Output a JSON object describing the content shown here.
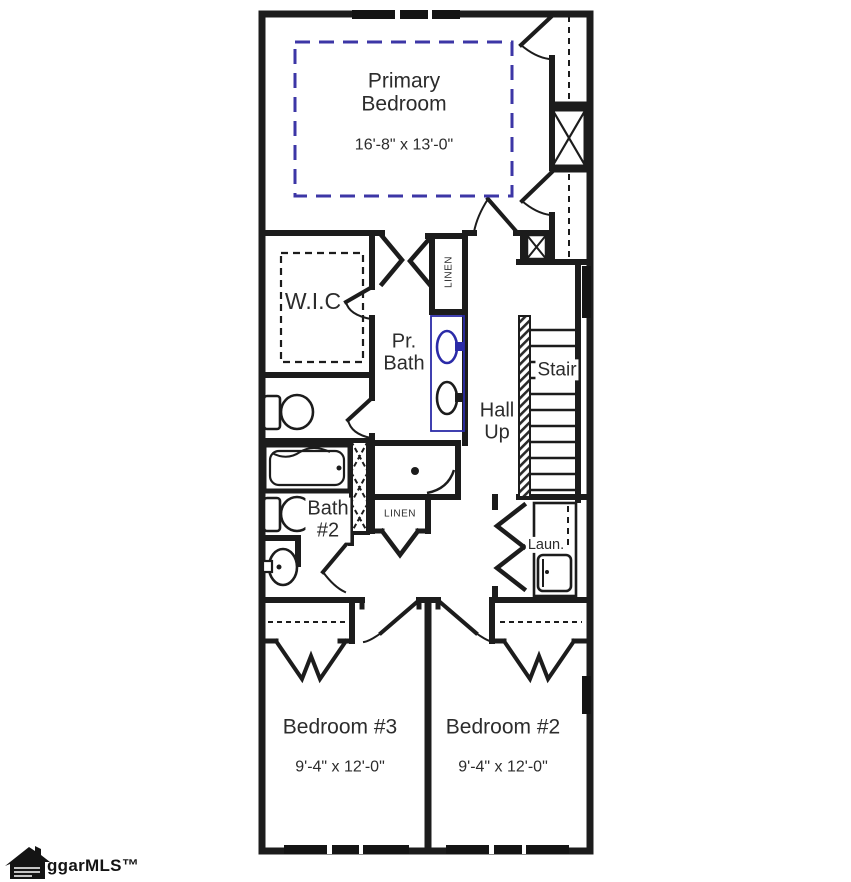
{
  "plan": {
    "rooms": {
      "primary_bedroom": {
        "name": "Primary\nBedroom",
        "dimensions": "16'-8\" x 13'-0\""
      },
      "wic": {
        "name": "W.I.C"
      },
      "primary_bath": {
        "name": "Pr.\nBath"
      },
      "hall": {
        "name": "Hall\nUp"
      },
      "stair": {
        "name": "Stair"
      },
      "bath_2": {
        "name": "Bath\n#2"
      },
      "laundry": {
        "name": "Laun."
      },
      "linen_upper": {
        "name": "LINEN"
      },
      "linen_lower": {
        "name": "LINEN"
      },
      "bedroom_3": {
        "name": "Bedroom #3",
        "dimensions": "9'-4\" x 12'-0\""
      },
      "bedroom_2": {
        "name": "Bedroom #2",
        "dimensions": "9'-4\" x 12'-0\""
      }
    },
    "fixtures": [
      "toilet",
      "toilet",
      "bathtub",
      "shower",
      "double-vanity-sink",
      "pedestal-sink",
      "washer"
    ],
    "colors": {
      "wall_line": "#1c1c1c",
      "selection_dash_blue": "#3c36a6",
      "fixture_highlight_blue": "#2b2ba8",
      "background": "#ffffff"
    },
    "watermark": {
      "text": "ggarMLS™"
    }
  }
}
